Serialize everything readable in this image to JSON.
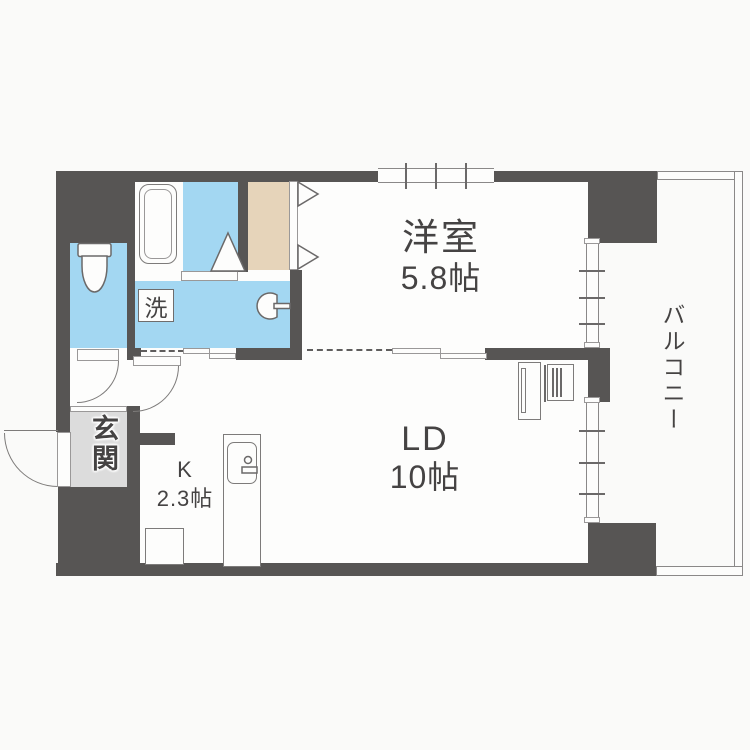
{
  "plan": {
    "type": "apartment-floor-plan",
    "rooms": {
      "western_room": {
        "name": "洋室",
        "size": "5.8帖"
      },
      "living_dining": {
        "name": "LD",
        "size": "10帖"
      },
      "kitchen": {
        "name": "K",
        "size": "2.3帖"
      },
      "balcony": {
        "name": "バルコニー"
      },
      "entrance": {
        "name": "玄関"
      },
      "laundry": {
        "name": "洗"
      }
    },
    "colors": {
      "wall": "#575554",
      "water": "#a3d7f2",
      "closet": "#e6d4ba",
      "entrance_floor": "#dcdcdc",
      "background": "#fafaf9",
      "line": "#7d7b7a",
      "text": "#454343"
    }
  }
}
